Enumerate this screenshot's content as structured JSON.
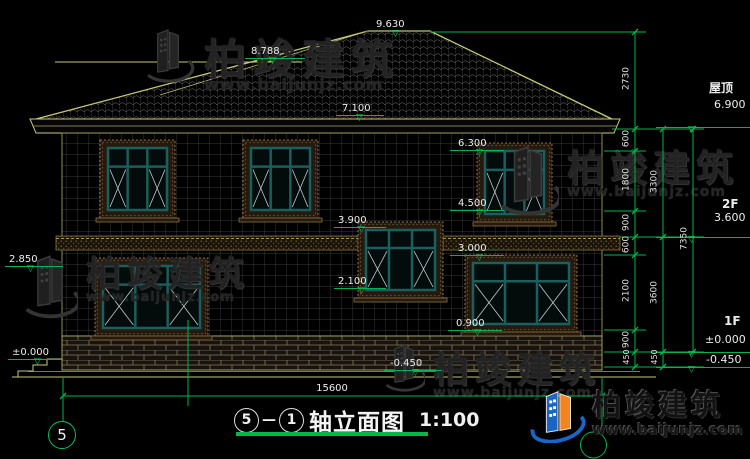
{
  "title": {
    "axis_start": "5",
    "separator": "—",
    "axis_end": "1",
    "name": "轴立面图",
    "scale": "1:100"
  },
  "axis_bubble_left": "5",
  "watermark": {
    "brand": "柏竣建筑",
    "site": "www.baijunjz.com"
  },
  "logo": {
    "brand": "柏竣建筑",
    "site": "www.baijunjz.com"
  },
  "elevations": {
    "ridge": "9.630",
    "sub_ridge": "8.788",
    "eave": "7.100",
    "win2f_top": "6.300",
    "win2f_sill": "4.500",
    "stair_top": "3.900",
    "belt": "3.000",
    "stair_sill": "2.100",
    "win1f_sill": "0.900",
    "base_mid": "-0.450",
    "left_belt": "2.850",
    "left_ground": "±0.000"
  },
  "levels_right": {
    "roof_label": "屋顶",
    "roof_value": "6.900",
    "f2_label": "2F",
    "f2_value": "3.600",
    "f1_label": "1F",
    "f1_value": "±0.000",
    "base_value": "-0.450"
  },
  "dims": {
    "chain_a": [
      "2730",
      "600",
      "1800",
      "900",
      "600",
      "2100",
      "900",
      "450"
    ],
    "chain_b": [
      "3300",
      "3600",
      "450"
    ],
    "chain_c": [
      "7350"
    ],
    "total_width": "15600"
  },
  "colors": {
    "dim_green": "#00b44c",
    "roof_yellow": "#c8c878",
    "text": "#ececec",
    "logo_blue": "#1a66c4",
    "logo_orange": "#f08522"
  }
}
